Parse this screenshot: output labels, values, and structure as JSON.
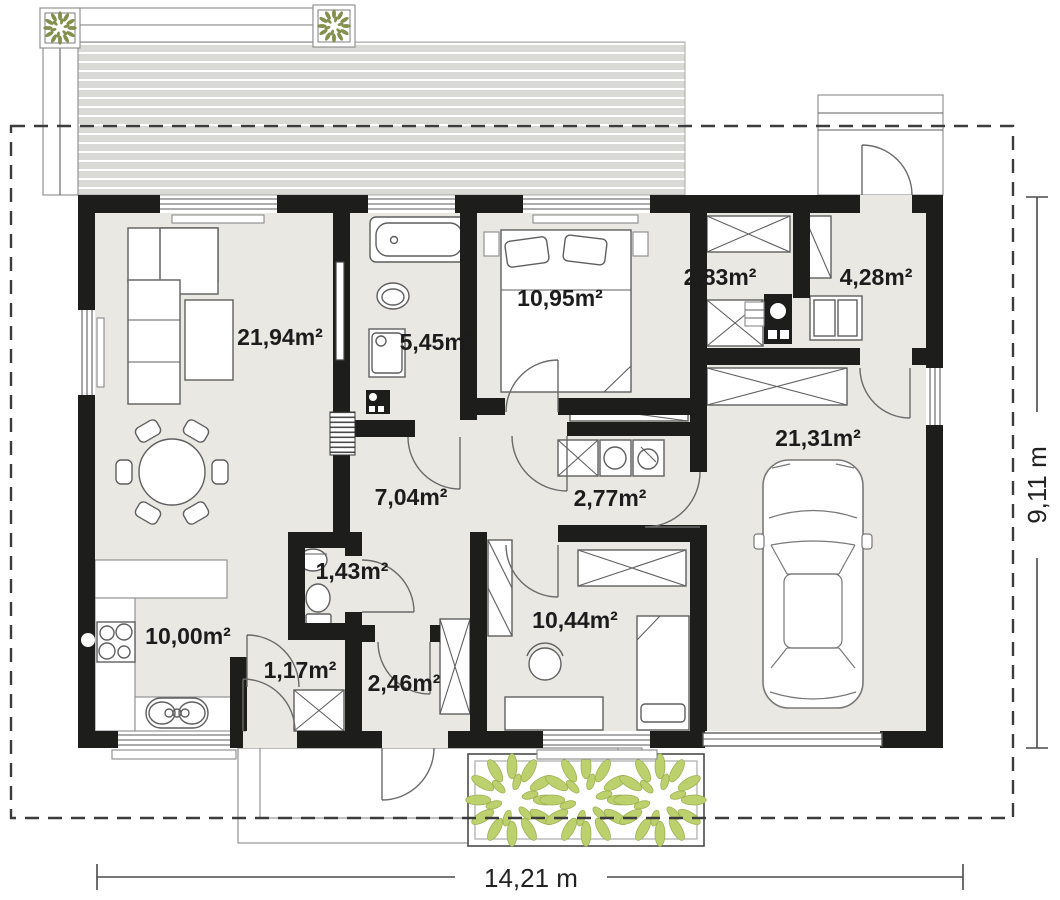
{
  "plan": {
    "rooms": {
      "living": "21,94m²",
      "bathroom": "5,45m²",
      "bedroom_top": "10,95m²",
      "storage": "2,83m²",
      "entry_vestibule": "4,28m²",
      "hall": "7,04m²",
      "utility_corridor": "2,77m²",
      "garage": "21,31m²",
      "wc": "1,43m²",
      "kitchen": "10,00m²",
      "back_hall": "1,17m²",
      "back_corridor": "2,46m²",
      "bedroom_bottom": "10,44m²"
    },
    "dimensions": {
      "width": "14,21 m",
      "height": "9,11 m"
    },
    "colors": {
      "wall": "#1d1d1b",
      "floor": "#e9e8e3",
      "terrace": "#d9d9d6",
      "plant_leaf": "#bdd06e",
      "plant_small": "#84914b",
      "dash": "#3c3c3c"
    }
  }
}
